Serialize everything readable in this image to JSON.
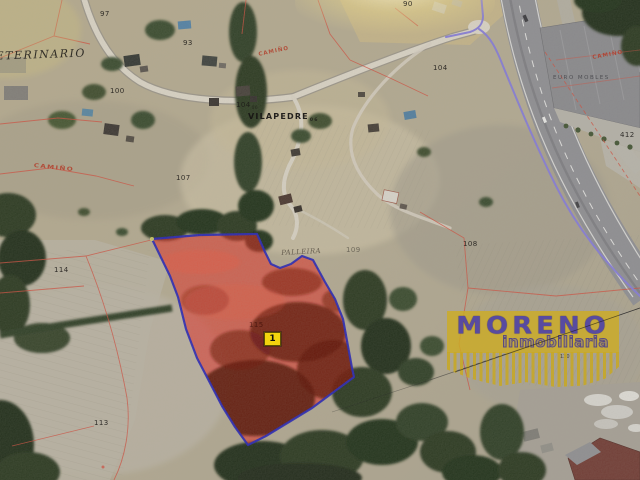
{
  "watermark": {
    "brand": "MORENO",
    "tagline": "inmobiliaria",
    "ref": "130"
  },
  "highlight": {
    "marker_label": "1"
  },
  "places": {
    "veterinario": "VETERINARIO",
    "vilapedre": {
      "text": "VILAPEDRE",
      "sheet": "06"
    },
    "palleira": "PALLEIRA",
    "euro_mobles": "EURO MOBLES"
  },
  "roads": {
    "camino_top": "CAMIÑO",
    "camino_right": "CAMIÑO",
    "camino_left": "CAMIÑO"
  },
  "parcels": {
    "n97": "97",
    "n93": "93",
    "n100": "100",
    "n90": "90",
    "n104_top": {
      "text": "104",
      "sheet": "06"
    },
    "n104_right": "104",
    "n107": "107",
    "n109": "109",
    "n108": "108",
    "n412": "412",
    "n114": "114",
    "n115": "115",
    "n113": "113"
  },
  "colors": {
    "highlight_fill": "#e1231a",
    "highlight_border": "#2121b5",
    "boundary_line": "#8278d8",
    "cadastral_line": "#cf4a3a",
    "watermark_gold": "#c6a722",
    "watermark_text": "#5d50a4",
    "marker_yellow": "#f2d40e"
  }
}
